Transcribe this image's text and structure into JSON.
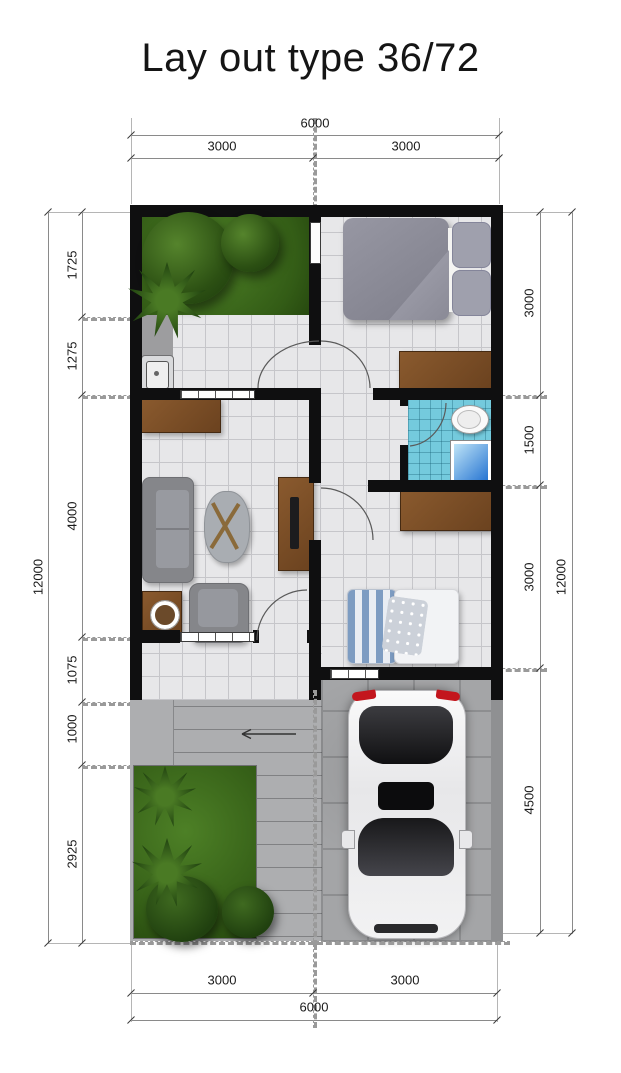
{
  "title": "Lay out type 36/72",
  "dimensions": {
    "top": {
      "overall": "6000",
      "segments": [
        "3000",
        "3000"
      ]
    },
    "bottom": {
      "overall": "6000",
      "segments": [
        "3000",
        "3000"
      ]
    },
    "left": {
      "overall": "12000",
      "segments": [
        "1725",
        "1275",
        "4000",
        "1075",
        "1000",
        "2925"
      ]
    },
    "right": {
      "overall": "12000",
      "segments": [
        "3000",
        "1500",
        "3000",
        "4500"
      ]
    }
  },
  "plan": {
    "features": [
      "courtyard-garden",
      "master-bedroom",
      "kitchenette",
      "bathroom",
      "living-room",
      "second-bedroom",
      "porch",
      "steps",
      "front-garden",
      "carport",
      "car"
    ],
    "colors": {
      "wall": "#0f0f10",
      "floor_tile": "#e7e7e9",
      "grass": "#3c671c",
      "bathroom_tile": "#74cadd",
      "wood": "#7a4a25",
      "concrete": "#a6a7a9",
      "car_body": "#f2f2f3",
      "taillight_red": "#c3161d"
    }
  }
}
